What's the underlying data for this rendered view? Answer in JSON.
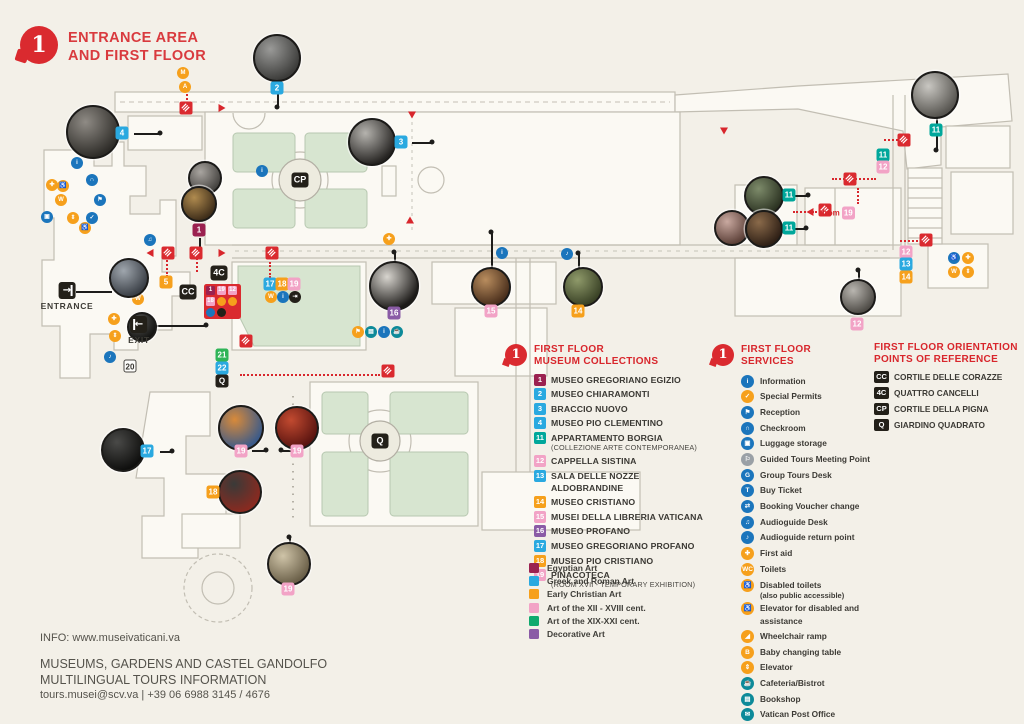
{
  "header": {
    "floor_number": "1",
    "title_line1": "ENTRANCE AREA",
    "title_line2": "AND FIRST FLOOR"
  },
  "palette": {
    "accent_red": "#da2a2f",
    "blue": "#2aa9e0",
    "orange": "#f6a01c",
    "pink": "#f2a3c6",
    "teal": "#00a79b",
    "purple": "#8a5ba6",
    "maroon": "#9b2150",
    "green": "#2fb457",
    "service_blue": "#1b75bc",
    "service_teal": "#0d8a99",
    "service_gray": "#9aa0a6",
    "black": "#232019",
    "background": "#f3f0e8",
    "map_green": "#d7e5d0"
  },
  "collections": {
    "badge": "1",
    "heading_line1": "FIRST FLOOR",
    "heading_line2": "MUSEUM COLLECTIONS",
    "items": [
      {
        "num": "1",
        "color": "maroon",
        "label": "MUSEO GREGORIANO EGIZIO"
      },
      {
        "num": "2",
        "color": "blue",
        "label": "MUSEO CHIARAMONTI"
      },
      {
        "num": "3",
        "color": "blue",
        "label": "BRACCIO NUOVO"
      },
      {
        "num": "4",
        "color": "blue",
        "label": "MUSEO PIO CLEMENTINO"
      },
      {
        "num": "11",
        "color": "teal",
        "label": "APPARTAMENTO BORGIA",
        "sub": "(COLLEZIONE ARTE CONTEMPORANEA)"
      },
      {
        "num": "12",
        "color": "pink",
        "label": "CAPPELLA SISTINA"
      },
      {
        "num": "13",
        "color": "blue",
        "label": "SALA DELLE NOZZE ALDOBRANDINE"
      },
      {
        "num": "14",
        "color": "orange",
        "label": "MUSEO CRISTIANO"
      },
      {
        "num": "15",
        "color": "pink",
        "label": "MUSEI DELLA LIBRERIA VATICANA"
      },
      {
        "num": "16",
        "color": "purple",
        "label": "MUSEO PROFANO"
      },
      {
        "num": "17",
        "color": "blue",
        "label": "MUSEO GREGORIANO PROFANO"
      },
      {
        "num": "18",
        "color": "orange",
        "label": "MUSEO PIO CRISTIANO"
      },
      {
        "num": "19",
        "color": "pink",
        "label": "PINACOTECA",
        "sub": "(ROOM XVII - TEMPORARY EXHIBITION)"
      }
    ]
  },
  "legend": [
    {
      "color": "#9b2150",
      "label": "Egyptian Art"
    },
    {
      "color": "#2aa9e0",
      "label": "Greek and Roman Art"
    },
    {
      "color": "#f6a01c",
      "label": "Early Christian Art"
    },
    {
      "color": "#f2a3c6",
      "label": "Art of the XII - XVIII cent."
    },
    {
      "color": "#10a96e",
      "label": "Art of the XIX-XXI cent."
    },
    {
      "color": "#8a5ba6",
      "label": "Decorative Art"
    }
  ],
  "services": {
    "badge": "1",
    "heading_line1": "FIRST FLOOR",
    "heading_line2": "SERVICES",
    "items": [
      {
        "color": "blue",
        "icon": "information-icon",
        "glyph": "i",
        "label": "Information"
      },
      {
        "color": "orange",
        "icon": "special-permits-icon",
        "glyph": "✓",
        "label": "Special Permits"
      },
      {
        "color": "blue",
        "icon": "reception-icon",
        "glyph": "⚑",
        "label": "Reception"
      },
      {
        "color": "blue",
        "icon": "checkroom-icon",
        "glyph": "∩",
        "label": "Checkroom"
      },
      {
        "color": "blue",
        "icon": "luggage-icon",
        "glyph": "▣",
        "label": "Luggage storage"
      },
      {
        "color": "gray",
        "icon": "guided-tours-icon",
        "glyph": "⚐",
        "label": "Guided Tours Meeting Point"
      },
      {
        "color": "blue",
        "icon": "group-tours-icon",
        "glyph": "G",
        "label": "Group Tours Desk"
      },
      {
        "color": "blue",
        "icon": "buy-ticket-icon",
        "glyph": "T",
        "label": "Buy Ticket"
      },
      {
        "color": "blue",
        "icon": "voucher-icon",
        "glyph": "⇄",
        "label": "Booking Voucher change"
      },
      {
        "color": "blue",
        "icon": "audioguide-desk-icon",
        "glyph": "♫",
        "label": "Audioguide Desk"
      },
      {
        "color": "blue",
        "icon": "audioguide-return-icon",
        "glyph": "♪",
        "label": "Audioguide return point"
      },
      {
        "color": "orange",
        "icon": "first-aid-icon",
        "glyph": "✚",
        "label": "First aid"
      },
      {
        "color": "orange",
        "icon": "toilets-icon",
        "glyph": "WC",
        "label": "Toilets"
      },
      {
        "color": "orange",
        "icon": "disabled-toilets-icon",
        "glyph": "♿",
        "label": "Disabled toilets",
        "sub": "(also public accessible)"
      },
      {
        "color": "orange",
        "icon": "elevator-disabled-icon",
        "glyph": "♿",
        "label": "Elevator for disabled and assistance"
      },
      {
        "color": "orange",
        "icon": "wheelchair-ramp-icon",
        "glyph": "◢",
        "label": "Wheelchair ramp"
      },
      {
        "color": "orange",
        "icon": "baby-changing-icon",
        "glyph": "B",
        "label": "Baby changing table"
      },
      {
        "color": "orange",
        "icon": "elevator-icon",
        "glyph": "⇕",
        "label": "Elevator"
      },
      {
        "color": "teal",
        "icon": "cafeteria-icon",
        "glyph": "☕",
        "label": "Cafeteria/Bistrot"
      },
      {
        "color": "teal",
        "icon": "bookshop-icon",
        "glyph": "▤",
        "label": "Bookshop"
      },
      {
        "color": "teal",
        "icon": "post-office-icon",
        "glyph": "✉",
        "label": "Vatican Post Office"
      }
    ]
  },
  "orientation": {
    "heading_line1": "FIRST FLOOR ORIENTATION",
    "heading_line2": "POINTS OF REFERENCE",
    "items": [
      {
        "code": "CC",
        "label": "CORTILE DELLE CORAZZE"
      },
      {
        "code": "4C",
        "label": "QUATTRO CANCELLI"
      },
      {
        "code": "CP",
        "label": "CORTILE DELLA PIGNA"
      },
      {
        "code": "Q",
        "label": "GIARDINO QUADRATO"
      }
    ]
  },
  "footer": {
    "info": "INFO: www.museivaticani.va",
    "line1": "MUSEUMS, GARDENS AND CASTEL GANDOLFO",
    "line2": "MULTILINGUAL TOURS INFORMATION",
    "line3": "tours.musei@scv.va | +39 06 6988 3145 / 4676"
  },
  "map": {
    "entrance_label": "ENTRANCE",
    "exit_label": "EXIT",
    "from_label": "from",
    "from_badge": "19",
    "markers": [
      {
        "t": "2",
        "c": "blue",
        "x": 277,
        "y": 88
      },
      {
        "t": "4",
        "c": "blue",
        "x": 122,
        "y": 133
      },
      {
        "t": "3",
        "c": "blue",
        "x": 401,
        "y": 142
      },
      {
        "t": "1",
        "c": "maroon",
        "x": 199,
        "y": 230
      },
      {
        "t": "5",
        "c": "orange",
        "x": 166,
        "y": 282
      },
      {
        "t": "11",
        "c": "teal",
        "x": 789,
        "y": 195
      },
      {
        "t": "11",
        "c": "teal",
        "x": 789,
        "y": 228
      },
      {
        "t": "11",
        "c": "teal",
        "x": 936,
        "y": 130
      },
      {
        "t": "11",
        "c": "teal",
        "x": 883,
        "y": 155
      },
      {
        "t": "12",
        "c": "pink",
        "x": 883,
        "y": 167
      },
      {
        "t": "12",
        "c": "pink",
        "x": 857,
        "y": 324
      },
      {
        "t": "12",
        "c": "pink",
        "x": 906,
        "y": 252
      },
      {
        "t": "13",
        "c": "blue",
        "x": 906,
        "y": 264
      },
      {
        "t": "14",
        "c": "orange",
        "x": 906,
        "y": 277
      },
      {
        "t": "14",
        "c": "orange",
        "x": 578,
        "y": 311
      },
      {
        "t": "15",
        "c": "pink",
        "x": 491,
        "y": 311
      },
      {
        "t": "16",
        "c": "purple",
        "x": 394,
        "y": 313
      },
      {
        "t": "17",
        "c": "blue",
        "x": 147,
        "y": 451
      },
      {
        "t": "18",
        "c": "orange",
        "x": 213,
        "y": 492
      },
      {
        "t": "19",
        "c": "pink",
        "x": 241,
        "y": 451
      },
      {
        "t": "19",
        "c": "pink",
        "x": 297,
        "y": 451
      },
      {
        "t": "19",
        "c": "pink",
        "x": 288,
        "y": 589
      },
      {
        "t": "20",
        "c": "white",
        "x": 130,
        "y": 366
      },
      {
        "t": "21",
        "c": "green",
        "x": 222,
        "y": 355
      },
      {
        "t": "22",
        "c": "blue",
        "x": 222,
        "y": 368
      },
      {
        "t": "Q",
        "c": "black",
        "x": 222,
        "y": 381
      },
      {
        "t": "17",
        "c": "blue",
        "x": 270,
        "y": 284
      },
      {
        "t": "18",
        "c": "orange",
        "x": 282,
        "y": 284
      },
      {
        "t": "19",
        "c": "pink",
        "x": 294,
        "y": 284
      },
      {
        "t": "CP",
        "c": "black big",
        "x": 300,
        "y": 180
      },
      {
        "t": "Q",
        "c": "black big",
        "x": 380,
        "y": 441
      },
      {
        "t": "CC",
        "c": "black big",
        "x": 188,
        "y": 292
      },
      {
        "t": "4C",
        "c": "black big",
        "x": 219,
        "y": 273
      }
    ],
    "photos": [
      [
        277,
        58,
        22,
        "#9a9a98",
        "#3c3c3a"
      ],
      [
        93,
        132,
        25,
        "#8f8b85",
        "#2e2c28"
      ],
      [
        372,
        142,
        22,
        "#b5b3ae",
        "#262422"
      ],
      [
        205,
        178,
        15,
        "#a9a5a0",
        "#454340"
      ],
      [
        199,
        204,
        16,
        "#b08b4f",
        "#3f2e1a"
      ],
      [
        129,
        278,
        18,
        "#9fa6ad",
        "#3a3f46"
      ],
      [
        142,
        327,
        13,
        "#5a5a58",
        "#141412"
      ],
      [
        394,
        286,
        23,
        "#d8d5cf",
        "#1d1b19"
      ],
      [
        491,
        287,
        18,
        "#b98d5e",
        "#4a2f1c"
      ],
      [
        583,
        287,
        18,
        "#8f9a6a",
        "#3a4226"
      ],
      [
        764,
        196,
        18,
        "#7d8b6a",
        "#2c3322"
      ],
      [
        732,
        228,
        16,
        "#c9a9a0",
        "#5c4038"
      ],
      [
        764,
        229,
        17,
        "#8a6a4a",
        "#2f2016"
      ],
      [
        858,
        297,
        16,
        "#b9b6b0",
        "#4e4b46"
      ],
      [
        935,
        95,
        22,
        "#c9c7c2",
        "#56544f"
      ],
      [
        123,
        450,
        20,
        "#4a4a48",
        "#0f0f0e"
      ],
      [
        241,
        428,
        21,
        "#d88a3a",
        "#3a5a8a"
      ],
      [
        297,
        428,
        20,
        "#c24a30",
        "#5a1410"
      ],
      [
        240,
        492,
        20,
        "#3a3a38",
        "#8a2a20"
      ],
      [
        289,
        564,
        20,
        "#cfc4a8",
        "#6a5f48"
      ]
    ],
    "lines": [
      [
        277,
        72,
        277,
        107
      ],
      [
        134,
        133,
        160,
        133
      ],
      [
        412,
        142,
        432,
        142
      ],
      [
        199,
        238,
        199,
        250
      ],
      [
        394,
        252,
        394,
        264
      ],
      [
        491,
        232,
        491,
        269
      ],
      [
        578,
        253,
        578,
        270
      ],
      [
        936,
        116,
        936,
        150
      ],
      [
        780,
        195,
        808,
        195
      ],
      [
        781,
        228,
        806,
        228
      ],
      [
        160,
        451,
        172,
        451
      ],
      [
        252,
        450,
        266,
        450
      ],
      [
        281,
        450,
        291,
        450
      ],
      [
        289,
        537,
        289,
        577
      ],
      [
        858,
        270,
        858,
        281
      ],
      [
        76,
        291,
        112,
        291
      ],
      [
        151,
        325,
        206,
        325
      ]
    ],
    "dots": [
      [
        277,
        107
      ],
      [
        160,
        133
      ],
      [
        432,
        142
      ],
      [
        199,
        250
      ],
      [
        394,
        252
      ],
      [
        491,
        232
      ],
      [
        578,
        253
      ],
      [
        936,
        150
      ],
      [
        808,
        195
      ],
      [
        806,
        228
      ],
      [
        172,
        451
      ],
      [
        266,
        450
      ],
      [
        281,
        450
      ],
      [
        289,
        537
      ],
      [
        858,
        270
      ],
      [
        206,
        325
      ]
    ],
    "stairs": [
      [
        186,
        108
      ],
      [
        168,
        253
      ],
      [
        196,
        253
      ],
      [
        272,
        253
      ],
      [
        246,
        341
      ],
      [
        388,
        371
      ],
      [
        825,
        210
      ],
      [
        850,
        179
      ],
      [
        904,
        140
      ],
      [
        926,
        240
      ]
    ],
    "arrows": [
      [
        222,
        108,
        "right"
      ],
      [
        150,
        253,
        "left"
      ],
      [
        222,
        253,
        "right"
      ],
      [
        412,
        115,
        "down"
      ],
      [
        410,
        220,
        "up"
      ],
      [
        810,
        212,
        "left"
      ],
      [
        724,
        131,
        "down"
      ]
    ],
    "icons": [
      [
        77,
        163,
        "blue",
        "i"
      ],
      [
        92,
        180,
        "blue",
        "∩"
      ],
      [
        52,
        185,
        "orange",
        "✚"
      ],
      [
        63,
        186,
        "orange",
        "♿"
      ],
      [
        61,
        200,
        "orange",
        "W"
      ],
      [
        47,
        217,
        "blue",
        "▣"
      ],
      [
        73,
        218,
        "orange",
        "⇕"
      ],
      [
        85,
        228,
        "orange",
        "♿"
      ],
      [
        92,
        218,
        "blue",
        "✓"
      ],
      [
        100,
        200,
        "blue",
        "⚑"
      ],
      [
        138,
        299,
        "orange",
        "W"
      ],
      [
        114,
        319,
        "orange",
        "✚"
      ],
      [
        115,
        336,
        "orange",
        "⇕"
      ],
      [
        110,
        357,
        "blue",
        "♪"
      ],
      [
        150,
        240,
        "blue",
        "♫"
      ],
      [
        358,
        332,
        "orange",
        "⚑"
      ],
      [
        371,
        332,
        "teal",
        "▤"
      ],
      [
        384,
        332,
        "blue",
        "i"
      ],
      [
        397,
        332,
        "teal",
        "☕"
      ],
      [
        502,
        253,
        "blue",
        "i"
      ],
      [
        567,
        254,
        "blue",
        "♪"
      ],
      [
        954,
        258,
        "blue",
        "♿"
      ],
      [
        968,
        258,
        "orange",
        "✚"
      ],
      [
        954,
        272,
        "orange",
        "W"
      ],
      [
        968,
        272,
        "orange",
        "⇕"
      ],
      [
        262,
        171,
        "blue",
        "i"
      ],
      [
        389,
        239,
        "orange",
        "✚"
      ],
      [
        183,
        73,
        "orange",
        "M"
      ],
      [
        185,
        87,
        "orange",
        "A"
      ],
      [
        271,
        297,
        "orange",
        "W"
      ],
      [
        283,
        297,
        "blue",
        "i"
      ],
      [
        295,
        297,
        "dark",
        "⇥"
      ]
    ],
    "dotted": [
      [
        240,
        374,
        140,
        "h"
      ],
      [
        166,
        257,
        20,
        "v"
      ],
      [
        196,
        258,
        14,
        "v"
      ],
      [
        186,
        90,
        14,
        "v"
      ],
      [
        832,
        178,
        44,
        "h"
      ],
      [
        793,
        211,
        24,
        "h"
      ],
      [
        884,
        139,
        18,
        "h"
      ],
      [
        900,
        240,
        18,
        "h"
      ],
      [
        857,
        188,
        16,
        "v"
      ],
      [
        269,
        262,
        16,
        "v"
      ]
    ],
    "entrance_panel": {
      "badges": [
        {
          "t": "1",
          "c": "maroon"
        },
        {
          "t": "19",
          "c": "pink"
        },
        {
          "t": "12",
          "c": "pink"
        },
        {
          "t": "18",
          "c": "pink"
        }
      ],
      "icons": [
        "#f6a01c",
        "#f6a01c",
        "#1b75bc",
        "#232019"
      ]
    }
  }
}
